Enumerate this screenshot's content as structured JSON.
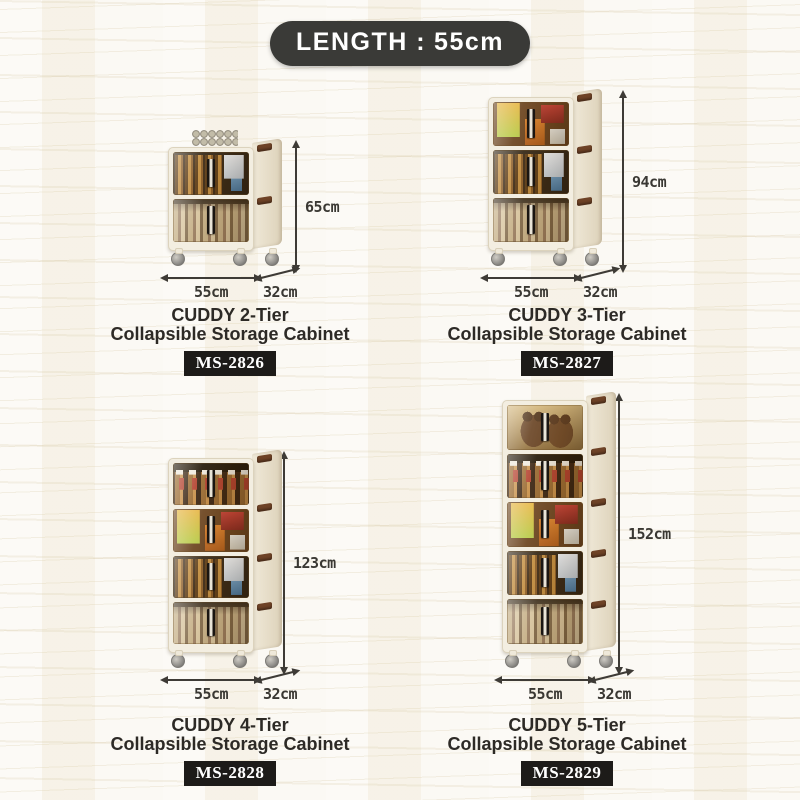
{
  "banner": {
    "label": "LENGTH :",
    "value": "55cm"
  },
  "products": [
    {
      "title": "CUDDY 2-Tier",
      "subtitle": "Collapsible Storage Cabinet",
      "model": "MS-2826",
      "height": "65cm",
      "width": "55cm",
      "depth": "32cm",
      "tiers": [
        "bottles",
        "books"
      ],
      "top_decor": "stacked-cans"
    },
    {
      "title": "CUDDY 3-Tier",
      "subtitle": "Collapsible Storage Cabinet",
      "model": "MS-2827",
      "height": "94cm",
      "width": "55cm",
      "depth": "32cm",
      "tiers": [
        "snacks",
        "bottles",
        "books"
      ]
    },
    {
      "title": "CUDDY 4-Tier",
      "subtitle": "Collapsible Storage Cabinet",
      "model": "MS-2828",
      "height": "123cm",
      "width": "55cm",
      "depth": "32cm",
      "tiers": [
        "jars",
        "snacks",
        "bottles",
        "books"
      ]
    },
    {
      "title": "CUDDY 5-Tier",
      "subtitle": "Collapsible Storage Cabinet",
      "model": "MS-2829",
      "height": "152cm",
      "width": "55cm",
      "depth": "32cm",
      "tiers": [
        "plush",
        "jars",
        "snacks",
        "bottles",
        "books"
      ]
    }
  ],
  "colors": {
    "background": "#f9f6ee",
    "banner_bg": "#3a3a37",
    "banner_text": "#ffffff",
    "badge_bg": "#1d1b19",
    "badge_text": "#ffffff",
    "heading_text": "#2d2a26",
    "dimension_text": "#3a3833",
    "cabinet_frame": "#f3eee1",
    "latch_brown": "#6e4226"
  }
}
